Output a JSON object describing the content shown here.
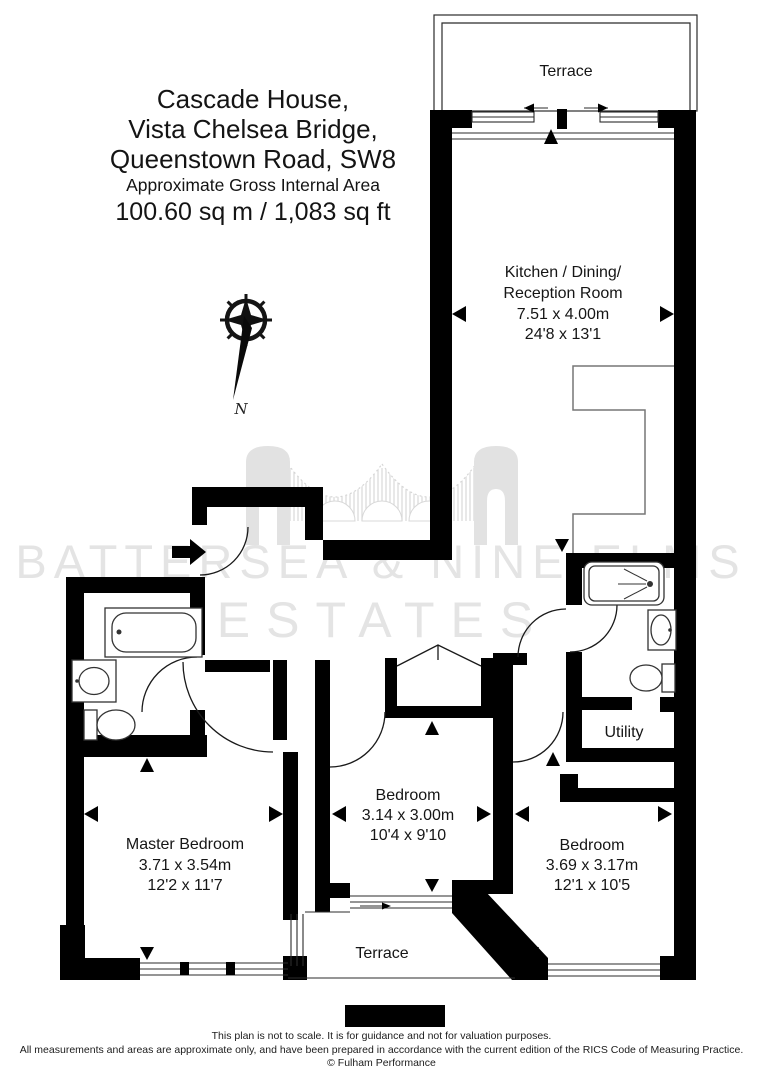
{
  "title": {
    "line1": "Cascade House,",
    "line2": "Vista Chelsea Bridge,",
    "line3": "Queenstown Road, SW8",
    "area_label": "Approximate Gross Internal Area",
    "area_value": "100.60 sq m / 1,083 sq ft"
  },
  "compass": {
    "north_label": "N"
  },
  "watermark": {
    "line1": "BATTERSEA & NINE ELMS",
    "line2": "ESTATES",
    "color": "#e4e4e4"
  },
  "rooms": {
    "terrace_top": {
      "name": "Terrace"
    },
    "kitchen": {
      "name_line1": "Kitchen / Dining/",
      "name_line2": "Reception Room",
      "dim_m": "7.51 x 4.00m",
      "dim_ft": "24'8 x 13'1"
    },
    "master": {
      "name": "Master Bedroom",
      "dim_m": "3.71 x 3.54m",
      "dim_ft": "12'2 x 11'7"
    },
    "bedroom_mid": {
      "name": "Bedroom",
      "dim_m": "3.14 x 3.00m",
      "dim_ft": "10'4 x 9'10"
    },
    "bedroom_right": {
      "name": "Bedroom",
      "dim_m": "3.69 x 3.17m",
      "dim_ft": "12'1 x 10'5"
    },
    "utility": {
      "name": "Utility"
    },
    "terrace_bottom": {
      "name": "Terrace"
    }
  },
  "footer": {
    "line1": "This plan is not to scale. It is for guidance and not for valuation purposes.",
    "line2": "All measurements and areas are approximate only, and have been prepared in accordance with the current edition of the RICS Code of Measuring Practice.",
    "line3": "© Fulham Performance"
  },
  "colors": {
    "wall": "#000000",
    "watermark": "#e4e4e4",
    "counter_line": "#777777",
    "text": "#161616"
  }
}
